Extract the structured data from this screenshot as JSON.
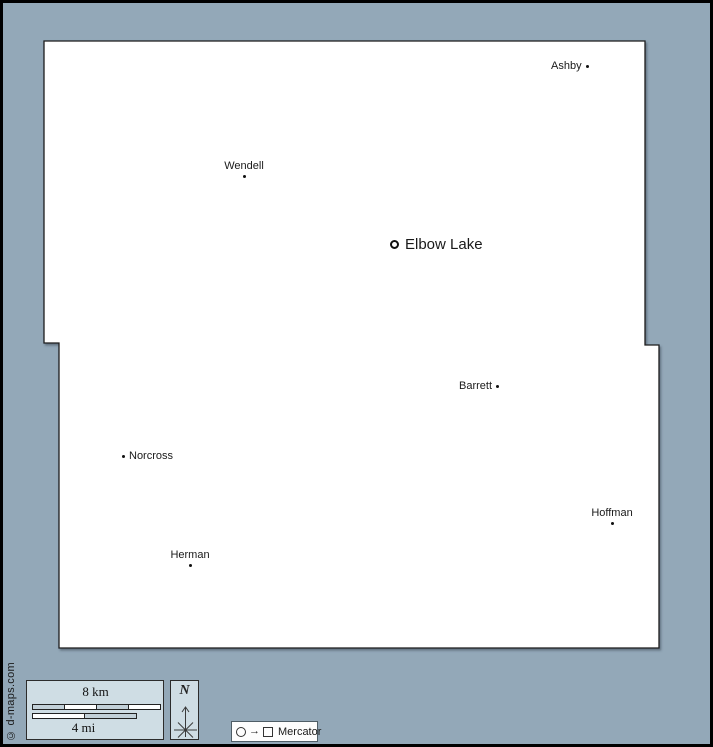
{
  "map": {
    "towns": [
      {
        "name": "Ashby",
        "marker": "dot",
        "layout": "label-left-of-dot",
        "x": 584,
        "y": 64
      },
      {
        "name": "Wendell",
        "marker": "dot",
        "layout": "label-above-dot",
        "x": 241,
        "y": 171
      },
      {
        "name": "Elbow Lake",
        "marker": "ring",
        "layout": "marker-left-of-label",
        "x": 392,
        "y": 242
      },
      {
        "name": "Barrett",
        "marker": "dot",
        "layout": "label-left-of-dot",
        "x": 497,
        "y": 384
      },
      {
        "name": "Norcross",
        "marker": "dot",
        "layout": "dot-left-of-label",
        "x": 122,
        "y": 454
      },
      {
        "name": "Hoffman",
        "marker": "dot",
        "layout": "label-above-dot",
        "x": 609,
        "y": 518
      },
      {
        "name": "Herman",
        "marker": "dot",
        "layout": "label-above-dot",
        "x": 187,
        "y": 564
      }
    ]
  },
  "legend": {
    "scale_bar": {
      "km_label": "8 km",
      "mi_label": "4 mi",
      "km_segments": 4,
      "mi_segments": 2
    },
    "compass": {
      "label": "N"
    },
    "projection": {
      "label": "Mercator",
      "symbols": "circle-arrow-square",
      "arrow_glyph": "→"
    }
  },
  "credit": {
    "text": "© d-maps.com"
  },
  "colors": {
    "background": "#93a8b8",
    "land": "#ffffff",
    "land_border": "#1b1b1b",
    "panel_fill": "#cfdde4",
    "bar_gray": "#c2d0d8",
    "outer_border": "#000000"
  }
}
